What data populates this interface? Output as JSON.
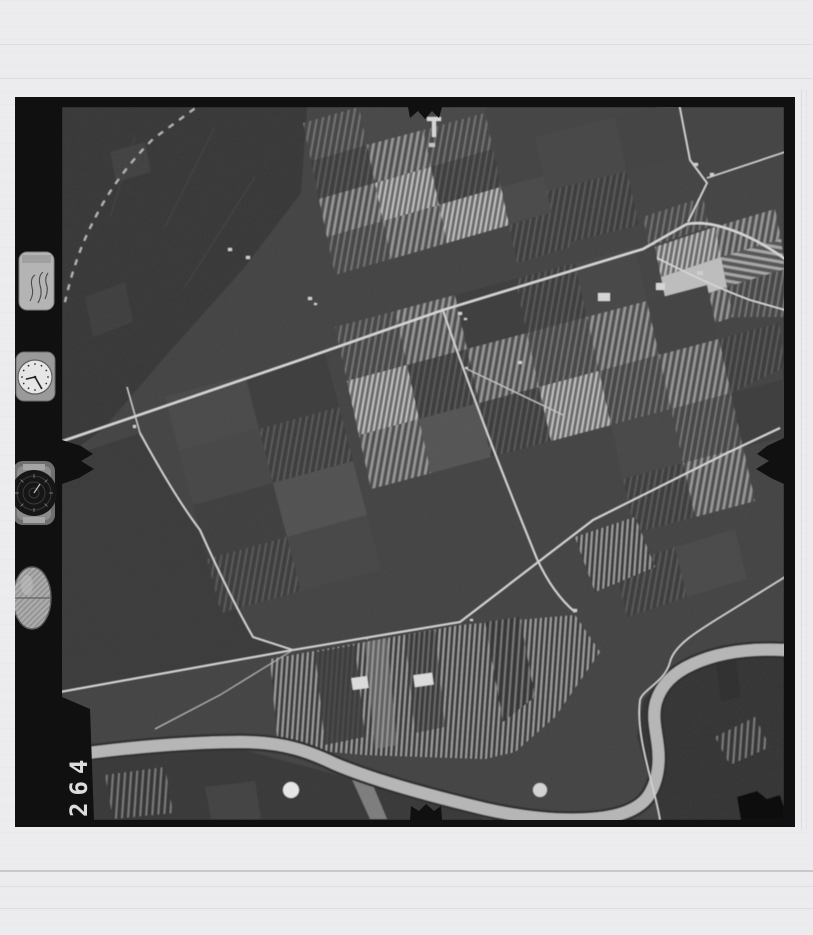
{
  "scene": {
    "kind": "black-and-white aerial survey film frame scan",
    "palette": {
      "page_background": "#ececef",
      "film_border": "#101010",
      "terrain_base": "#434343",
      "road": "#d6d6d6",
      "river": "#b6b6b6",
      "bright_field": "#c0c0c0"
    }
  },
  "film_strip": {
    "frame_number": "264",
    "instruments": [
      {
        "id": "data-plate",
        "name": "handwritten-data-plate"
      },
      {
        "id": "clock",
        "name": "clock-dial"
      },
      {
        "id": "altimeter",
        "name": "altimeter-dial"
      },
      {
        "id": "level",
        "name": "bubble-level"
      }
    ],
    "fiducial_marks": [
      "top-center",
      "bottom-center",
      "left-center",
      "right-center"
    ]
  },
  "photo_content": {
    "features": [
      "patchwork farm fields",
      "striped crop strips",
      "light rural roads",
      "meandering river",
      "farmsteads",
      "white storage tanks"
    ]
  }
}
